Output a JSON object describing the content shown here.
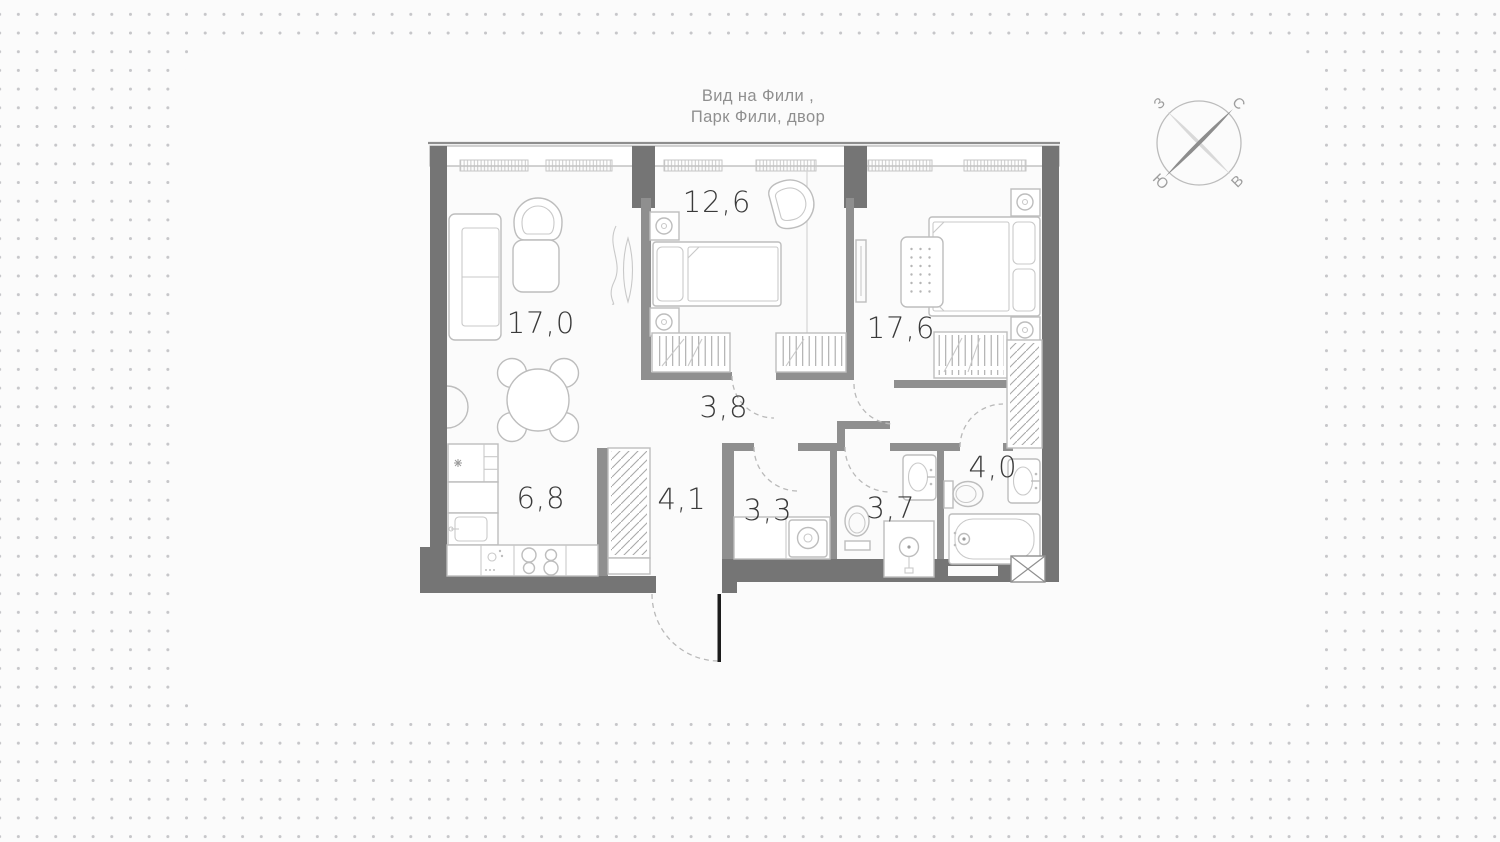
{
  "view_title": {
    "line1": "Вид на Фили ,",
    "line2": "Парк Фили, двор"
  },
  "compass": {
    "west": "З",
    "north": "С",
    "south": "Ю",
    "east": "В"
  },
  "rooms": [
    {
      "name": "living-room",
      "area": "17,0"
    },
    {
      "name": "bedroom-small",
      "area": "12,6"
    },
    {
      "name": "bedroom-master",
      "area": "17,6"
    },
    {
      "name": "corridor",
      "area": "3,8"
    },
    {
      "name": "kitchen",
      "area": "6,8"
    },
    {
      "name": "entry-hall",
      "area": "4,1"
    },
    {
      "name": "bathroom-laundry",
      "area": "3,3"
    },
    {
      "name": "shower-room",
      "area": "3,7"
    },
    {
      "name": "bathroom-main",
      "area": "4,0"
    }
  ],
  "colors": {
    "background": "#fbfbfb",
    "dots": "#c6c6c9",
    "wall_dark": "#757575",
    "wall_interior": "#8f8f8f",
    "furniture_line": "#bdbdbd",
    "label_text": "#3a3a3a",
    "title_text": "#8f8f8f",
    "entrance_door": "#1c1c1c"
  }
}
